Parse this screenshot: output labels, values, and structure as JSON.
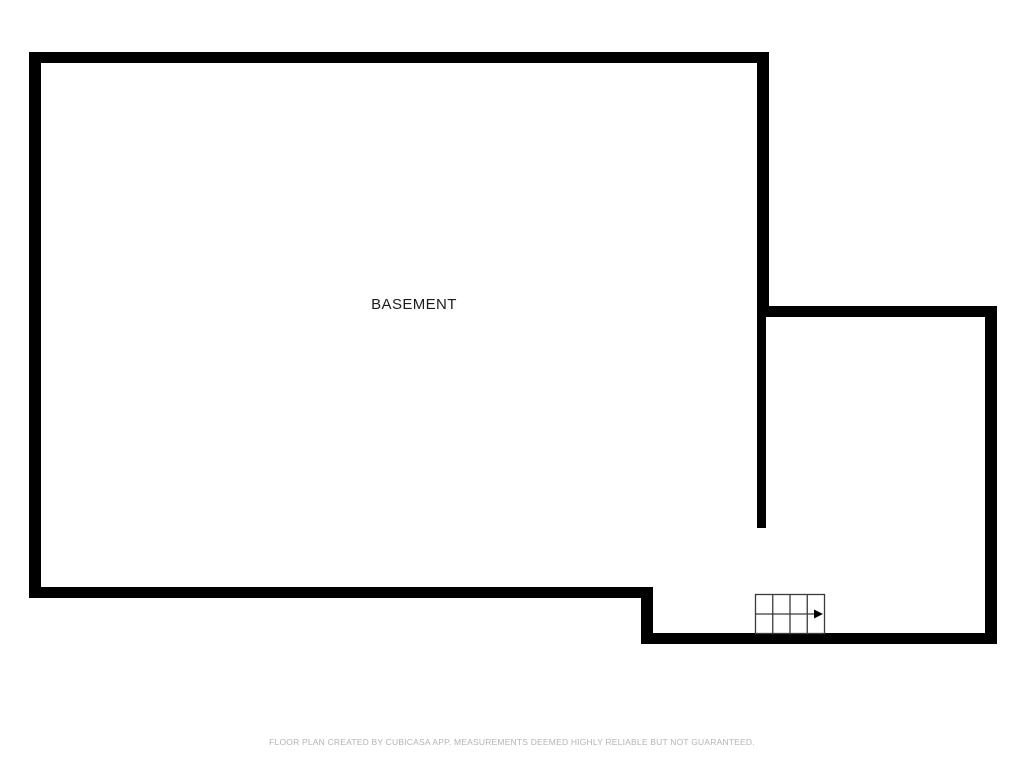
{
  "floorplan": {
    "room_label": "BASEMENT",
    "footer": "FLOOR PLAN CREATED BY CUBICASA APP. MEASUREMENTS DEEMED HIGHLY RELIABLE BUT NOT GUARANTEED.",
    "colors": {
      "background": "#ffffff",
      "wall": "#000000",
      "stair_line": "#3a3a3a",
      "arrow": "#000000",
      "label": "#1c1c1c",
      "footer": "#b4b4b4"
    }
  }
}
